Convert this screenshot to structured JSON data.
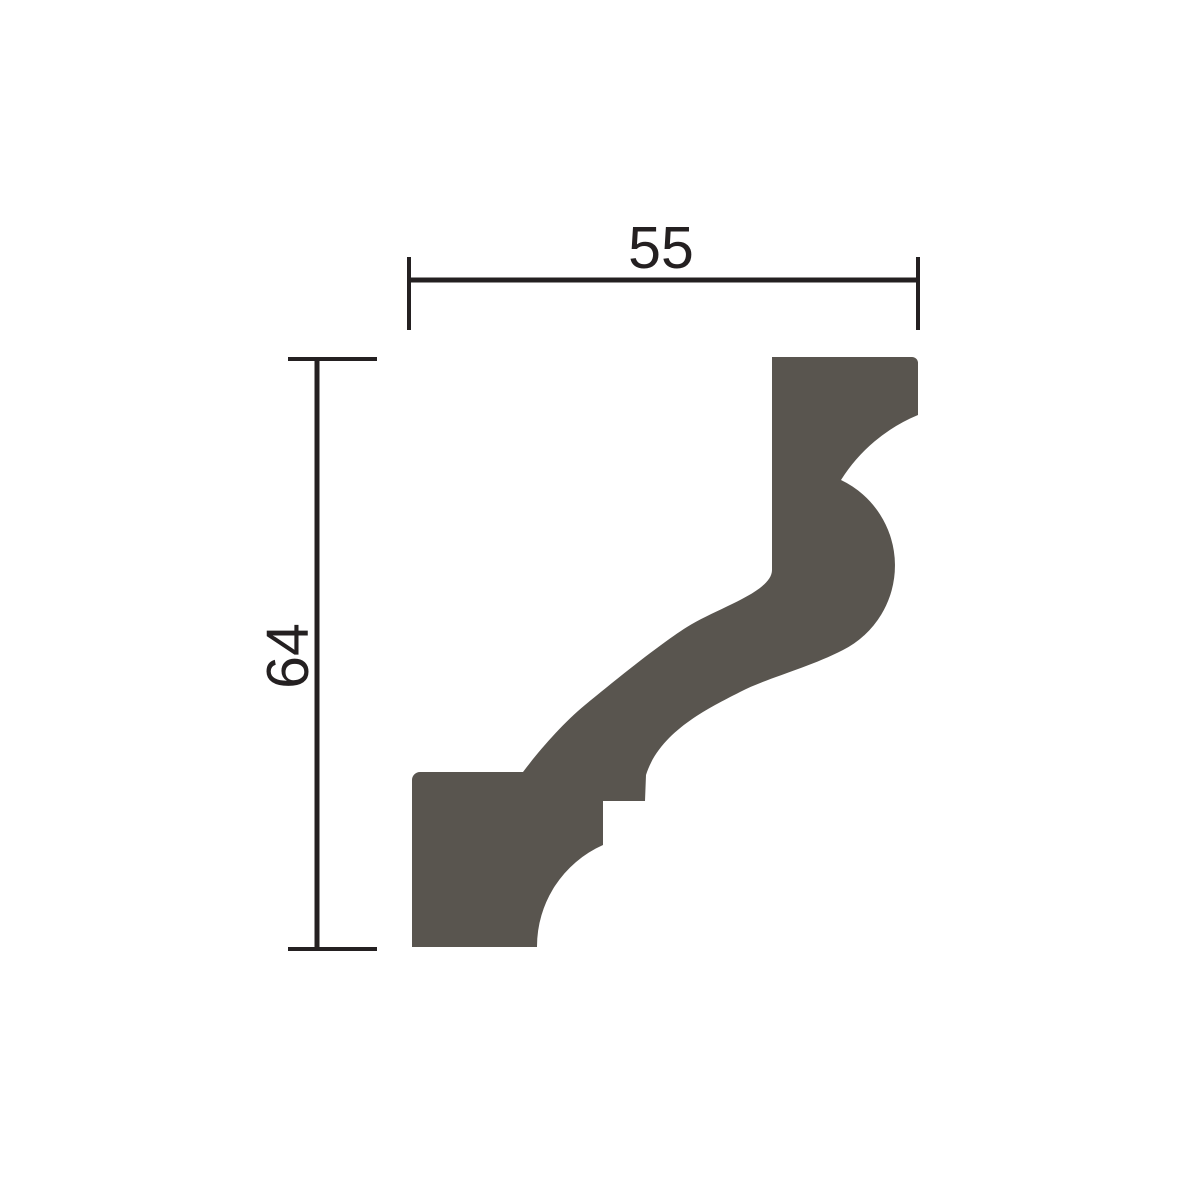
{
  "page": {
    "background": "#ffffff",
    "description": "Technical cross-section drawing of a crown molding (cornice) profile with width and height dimension lines"
  },
  "diagram": {
    "type": "molding-profile-cross-section",
    "dimensions": {
      "width": {
        "label": "55"
      },
      "height": {
        "label": "64"
      }
    },
    "colors": {
      "profile_fill": "#59554f",
      "line_color": "#242021"
    }
  }
}
